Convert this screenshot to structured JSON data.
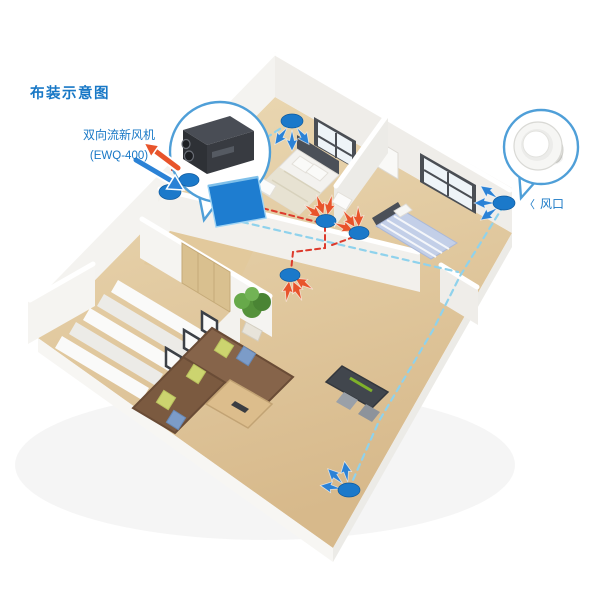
{
  "page": {
    "title": "布装示意图",
    "background": "#ffffff"
  },
  "device_callout": {
    "label": "双向流新风机",
    "model": "(EWQ-400)",
    "icon": "fresh-air-unit-photo"
  },
  "vent_callout": {
    "pointer": "〈",
    "label": "风口",
    "icon": "round-air-diffuser"
  },
  "colors": {
    "accent_blue": "#1878c6",
    "callout_ring": "#4f9fd8",
    "supply_duct": "#8fd2ec",
    "return_duct": "#dd3a2c",
    "vent_fill": "#1b79ca",
    "machine_fill": "#1e7dd0",
    "arrow_in": "#2b82d6",
    "arrow_out": "#e8542b",
    "floor_wood": "#e6cfa4",
    "wall_white": "#f4f3f0"
  },
  "diagram": {
    "type": "isometric-apartment-ventilation-schematic",
    "supply_vent_count": 3,
    "return_vent_count": 3,
    "fresh_air_unit_count": 1,
    "rooms": [
      "bedroom-1",
      "bedroom-2",
      "living-room",
      "hallway",
      "stairs"
    ]
  }
}
